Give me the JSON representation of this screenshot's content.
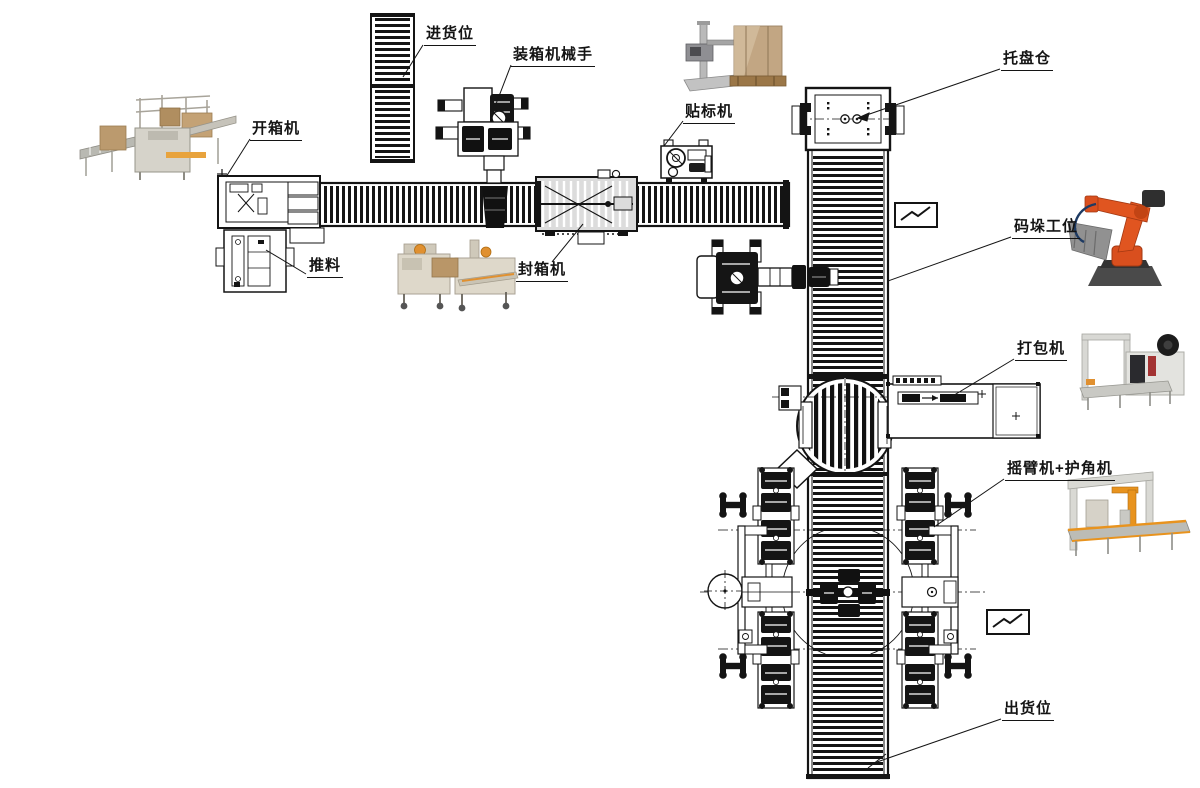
{
  "diagram": {
    "title": "packaging-palletizing-line-layout",
    "labels": {
      "infeed_position": "进货位",
      "case_packer_robot": "装箱机械手",
      "case_erector": "开箱机",
      "pusher": "推料",
      "case_sealer": "封箱机",
      "labeling_machine": "贴标机",
      "pallet_magazine": "托盘仓",
      "palletizing_station": "码垛工位",
      "strapping_machine": "打包机",
      "rotary_arm_wrapper": "摇臂机+护角机",
      "outfeed_position": "出货位"
    },
    "colors": {
      "line": "#141414",
      "background": "#ffffff",
      "robot_orange": "#df5220",
      "wrapper_orange": "#e8931e",
      "machine_beige": "#ddd7c9",
      "carton_brown": "#bb9a6e",
      "steel_gray": "#c9c9c4",
      "sealer_band_gray": "#dcdcdc"
    }
  }
}
